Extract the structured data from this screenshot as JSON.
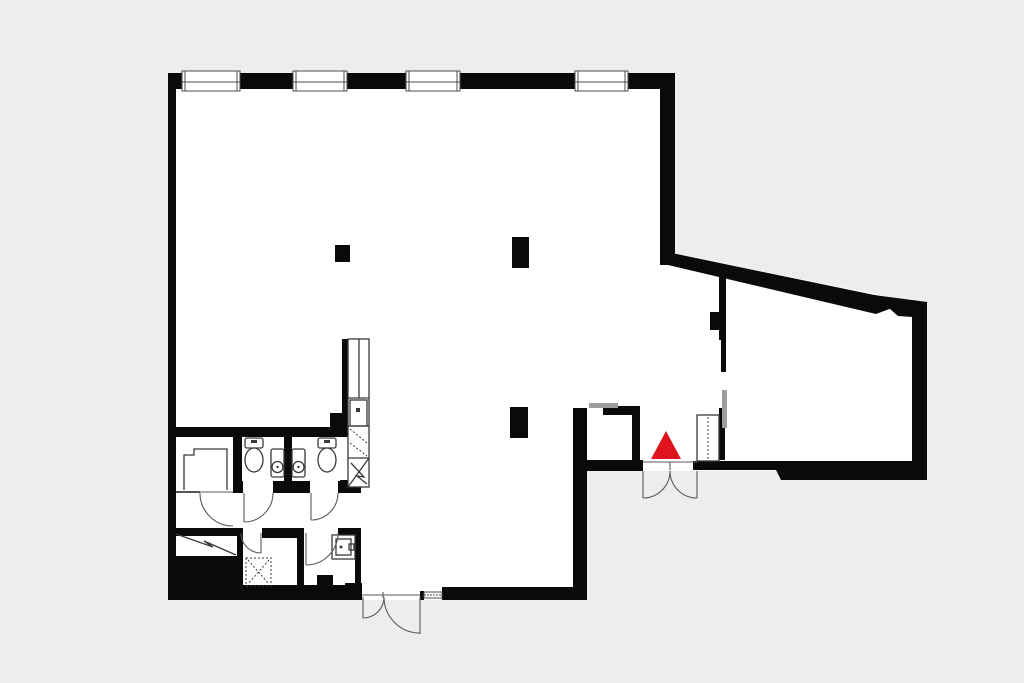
{
  "page": {
    "type": "architectural-floor-plan",
    "title": ""
  },
  "colors": {
    "background": "#ededed",
    "floor": "#ffffff",
    "wall": "#0a0a0a",
    "fixture_line": "#3a3a3a",
    "door_arc": "#5a5a5a",
    "sliding_door": "#9d9d9d",
    "entrance_marker": "#e0141c",
    "window_frame": "#4c4c4c",
    "thin_line": "#1a1a1a"
  },
  "marker": {
    "name": "entrance-marker",
    "shape": "triangle-up",
    "color": "#e0141c"
  },
  "inventory": {
    "windows_top_wall": 4,
    "structural_columns": 3,
    "toilets": 2,
    "wash_basins": 2,
    "utility_sinks": 1,
    "kitchen_units": 1,
    "double_doors": 2,
    "swing_doors": 5,
    "sliding_doors": 2,
    "cabinets": 2,
    "shaft_symbols": 2
  }
}
